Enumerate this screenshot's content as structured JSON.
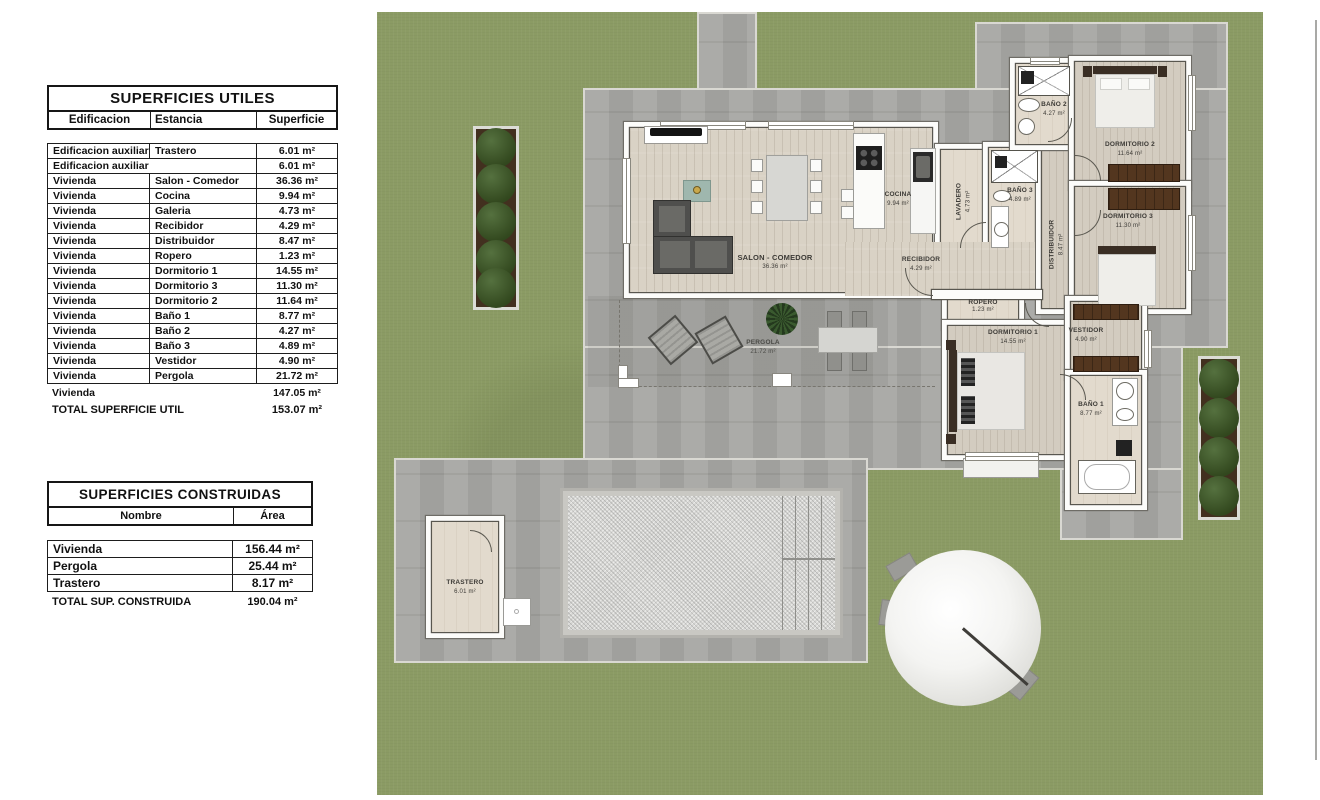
{
  "tables": {
    "utiles": {
      "title": "SUPERFICIES UTILES",
      "columns": [
        "Edificacion",
        "Estancia",
        "Superficie"
      ],
      "rows": [
        [
          "Edificacion auxiliar",
          "Trastero",
          "6.01 m²"
        ],
        [
          "Edificacion auxiliar",
          null,
          "6.01 m²"
        ],
        [
          "Vivienda",
          "Salon - Comedor",
          "36.36 m²"
        ],
        [
          "Vivienda",
          "Cocina",
          "9.94 m²"
        ],
        [
          "Vivienda",
          "Galeria",
          "4.73 m²"
        ],
        [
          "Vivienda",
          "Recibidor",
          "4.29 m²"
        ],
        [
          "Vivienda",
          "Distribuidor",
          "8.47 m²"
        ],
        [
          "Vivienda",
          "Ropero",
          "1.23 m²"
        ],
        [
          "Vivienda",
          "Dormitorio 1",
          "14.55 m²"
        ],
        [
          "Vivienda",
          "Dormitorio 3",
          "11.30 m²"
        ],
        [
          "Vivienda",
          "Dormitorio 2",
          "11.64 m²"
        ],
        [
          "Vivienda",
          "Baño 1",
          "8.77 m²"
        ],
        [
          "Vivienda",
          "Baño 2",
          "4.27 m²"
        ],
        [
          "Vivienda",
          "Baño 3",
          "4.89 m²"
        ],
        [
          "Vivienda",
          "Vestidor",
          "4.90 m²"
        ],
        [
          "Vivienda",
          "Pergola",
          "21.72 m²"
        ]
      ],
      "subtotal": {
        "label": "Vivienda",
        "value": "147.05 m²"
      },
      "total": {
        "label": "TOTAL SUPERFICIE UTIL",
        "value": "153.07 m²"
      }
    },
    "construidas": {
      "title": "SUPERFICIES CONSTRUIDAS",
      "columns": [
        "Nombre",
        "Área"
      ],
      "rows": [
        [
          "Vivienda",
          "156.44 m²"
        ],
        [
          "Pergola",
          "25.44 m²"
        ],
        [
          "Trastero",
          "8.17 m²"
        ]
      ],
      "total": {
        "label": "TOTAL SUP. CONSTRUIDA",
        "value": "190.04 m²"
      }
    }
  },
  "plan": {
    "rooms": {
      "salon": {
        "name": "SALON - COMEDOR",
        "area": "36.36 m²"
      },
      "cocina": {
        "name": "COCINA",
        "area": "9.94 m²"
      },
      "recibidor": {
        "name": "RECIBIDOR",
        "area": "4.29 m²"
      },
      "lavadero": {
        "name": "LAVADERO",
        "area": "4.73 m²"
      },
      "banyo3": {
        "name": "BAÑO 3",
        "area": "4.89 m²"
      },
      "distribuidor": {
        "name": "DISTRIBUIDOR",
        "area": "8.47 m²"
      },
      "banyo2": {
        "name": "BAÑO 2",
        "area": "4.27 m²"
      },
      "dormitorio2": {
        "name": "DORMITORIO 2",
        "area": "11.64 m²"
      },
      "dormitorio3": {
        "name": "DORMITORIO 3",
        "area": "11.30 m²"
      },
      "ropero": {
        "name": "ROPERO",
        "area": "1.23 m²"
      },
      "dormitorio1": {
        "name": "DORMITORIO 1",
        "area": "14.55 m²"
      },
      "vestidor": {
        "name": "VESTIDOR",
        "area": "4.90 m²"
      },
      "banyo1": {
        "name": "BAÑO 1",
        "area": "8.77 m²"
      },
      "pergola": {
        "name": "PERGOLA",
        "area": "21.72 m²"
      },
      "trastero": {
        "name": "TRASTERO",
        "area": "6.01 m²"
      }
    }
  },
  "colors": {
    "grass": "#8b9b64",
    "terrace": "#a7a7a3",
    "wood_floor": "#d9d2c5",
    "wall": "#fcfcfa",
    "table_border": "#1d1d1d",
    "bush": "#33491f",
    "wardrobe": "#53361f"
  }
}
